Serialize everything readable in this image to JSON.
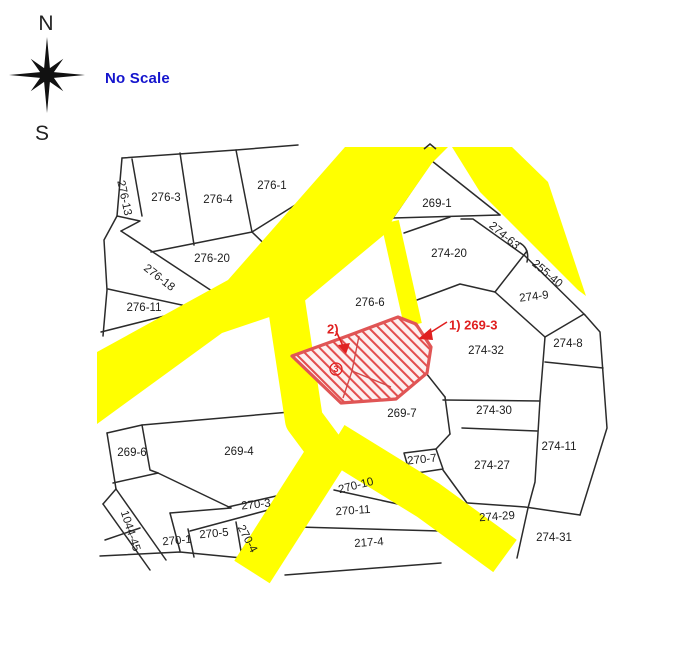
{
  "compass": {
    "north": "N",
    "south": "S"
  },
  "scale_note": {
    "text": "No Scale",
    "color": "#1414cd"
  },
  "map": {
    "road_color": "#ffff00",
    "boundary_color": "#2b2b2b",
    "highlight": {
      "color": "#e05555",
      "hatch_color": "#e34d4d",
      "annotations": [
        {
          "text": "1) 269-3",
          "x": 449,
          "y": 326,
          "anchor": "start",
          "size": 13,
          "circled": false
        },
        {
          "text": "2)",
          "x": 327,
          "y": 330,
          "anchor": "start",
          "size": 13,
          "circled": false
        },
        {
          "text": "3",
          "x": 336,
          "y": 369,
          "anchor": "middle",
          "size": 9,
          "circled": true
        }
      ]
    },
    "parcels": [
      {
        "text": "276-13",
        "x": 124,
        "y": 198,
        "rot": 78
      },
      {
        "text": "276-3",
        "x": 166,
        "y": 198,
        "rot": 0
      },
      {
        "text": "276-4",
        "x": 218,
        "y": 200,
        "rot": 0
      },
      {
        "text": "276-1",
        "x": 272,
        "y": 186,
        "rot": 0
      },
      {
        "text": "276-20",
        "x": 212,
        "y": 259,
        "rot": 0
      },
      {
        "text": "276-18",
        "x": 159,
        "y": 278,
        "rot": 38
      },
      {
        "text": "276-11",
        "x": 144,
        "y": 308,
        "rot": 0
      },
      {
        "text": "269-1",
        "x": 437,
        "y": 204,
        "rot": 0
      },
      {
        "text": "274-20",
        "x": 449,
        "y": 254,
        "rot": 0
      },
      {
        "text": "274-63",
        "x": 504,
        "y": 236,
        "rot": 40
      },
      {
        "text": "255-40",
        "x": 547,
        "y": 274,
        "rot": 40
      },
      {
        "text": "274-9",
        "x": 534,
        "y": 297,
        "rot": -7
      },
      {
        "text": "274-8",
        "x": 568,
        "y": 344,
        "rot": 0
      },
      {
        "text": "276-6",
        "x": 370,
        "y": 303,
        "rot": 0
      },
      {
        "text": "274-32",
        "x": 486,
        "y": 351,
        "rot": 0
      },
      {
        "text": "269-7",
        "x": 402,
        "y": 414,
        "rot": 0
      },
      {
        "text": "274-30",
        "x": 494,
        "y": 411,
        "rot": 0
      },
      {
        "text": "274-11",
        "x": 559,
        "y": 447,
        "rot": 0
      },
      {
        "text": "274-27",
        "x": 492,
        "y": 466,
        "rot": 0
      },
      {
        "text": "269-6",
        "x": 132,
        "y": 453,
        "rot": 0
      },
      {
        "text": "269-4",
        "x": 239,
        "y": 452,
        "rot": 0
      },
      {
        "text": "270-3",
        "x": 256,
        "y": 505,
        "rot": -6
      },
      {
        "text": "1044-45",
        "x": 130,
        "y": 531,
        "rot": 72
      },
      {
        "text": "270-1",
        "x": 177,
        "y": 541,
        "rot": -5
      },
      {
        "text": "270-5",
        "x": 214,
        "y": 534,
        "rot": -5
      },
      {
        "text": "270-4",
        "x": 247,
        "y": 539,
        "rot": 62
      },
      {
        "text": "270-7",
        "x": 422,
        "y": 460,
        "rot": -6
      },
      {
        "text": "270-10",
        "x": 356,
        "y": 486,
        "rot": -14
      },
      {
        "text": "270-11",
        "x": 353,
        "y": 511,
        "rot": -4
      },
      {
        "text": "217-4",
        "x": 369,
        "y": 543,
        "rot": -4
      },
      {
        "text": "274-29",
        "x": 497,
        "y": 517,
        "rot": -4
      },
      {
        "text": "274-31",
        "x": 554,
        "y": 538,
        "rot": 0
      }
    ]
  }
}
